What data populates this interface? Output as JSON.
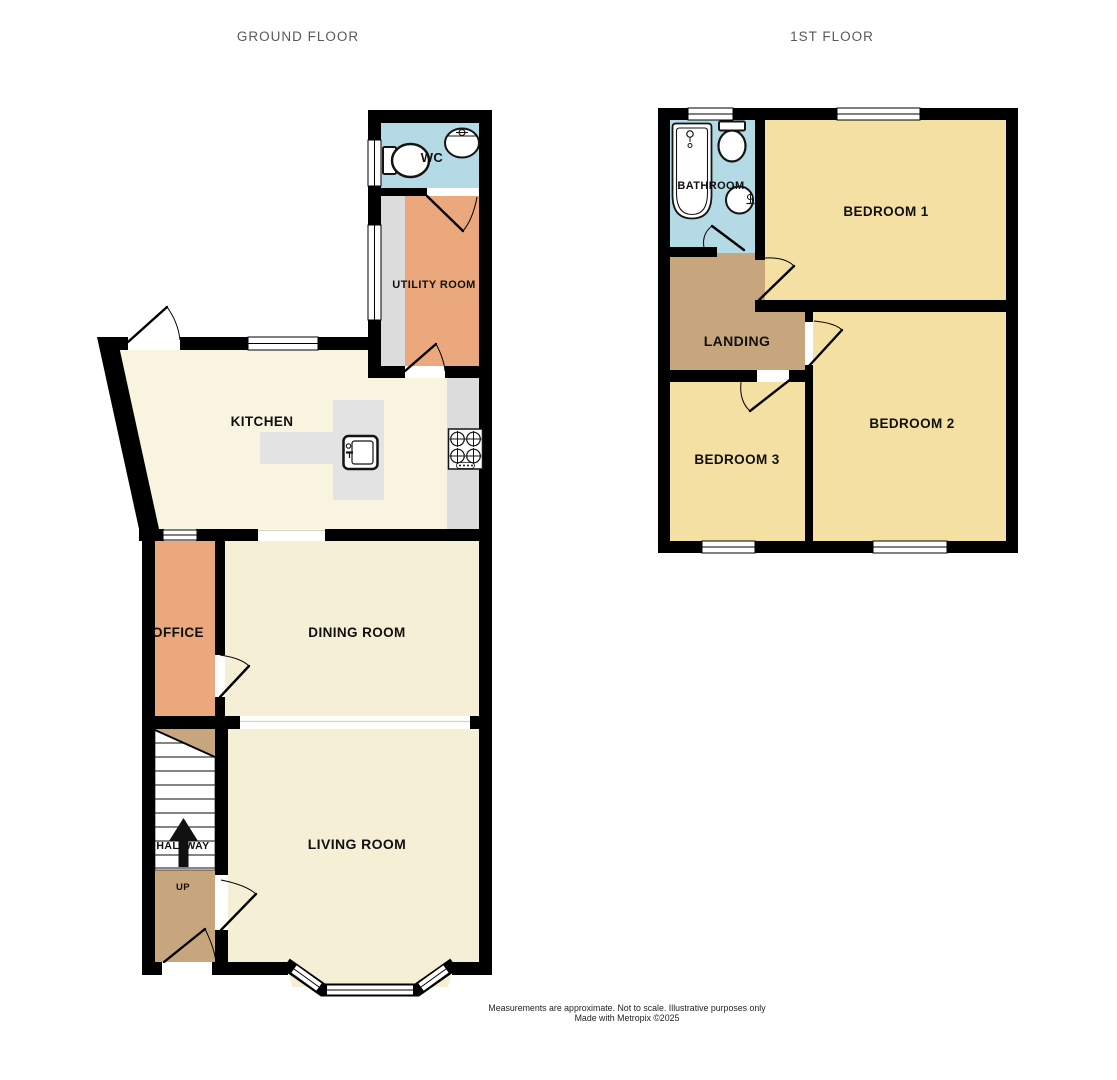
{
  "titles": {
    "ground_floor": "GROUND FLOOR",
    "first_floor": "1ST FLOOR"
  },
  "ground_floor": {
    "rooms": {
      "wc": "WC",
      "utility_room": "UTILITY ROOM",
      "kitchen": "KITCHEN",
      "office": "OFFICE",
      "dining_room": "DINING ROOM",
      "hallway": "HALLWAY",
      "living_room": "LIVING ROOM"
    },
    "stairs": {
      "direction_label": "UP"
    }
  },
  "first_floor": {
    "rooms": {
      "bathroom": "BATHROOM",
      "bedroom_1": "BEDROOM 1",
      "bedroom_2": "BEDROOM 2",
      "bedroom_3": "BEDROOM 3",
      "landing": "LANDING"
    }
  },
  "footer": {
    "line1": "Measurements are approximate.  Not to scale.  Illustrative purposes only",
    "line2": "Made with Metropix ©2025"
  },
  "colors": {
    "wall": "#000000",
    "bathroom_blue": "#b4dbe5",
    "utility_orange": "#eaa87c",
    "kitchen_cream": "#f8f4df",
    "living_cream": "#f5efd6",
    "hallway_tan": "#c8a67d",
    "bedroom_yellow": "#f4e0a2",
    "counter_gray": "#dcdcdc",
    "island_gray": "#e3e3e3",
    "title_gray": "#58595b"
  }
}
